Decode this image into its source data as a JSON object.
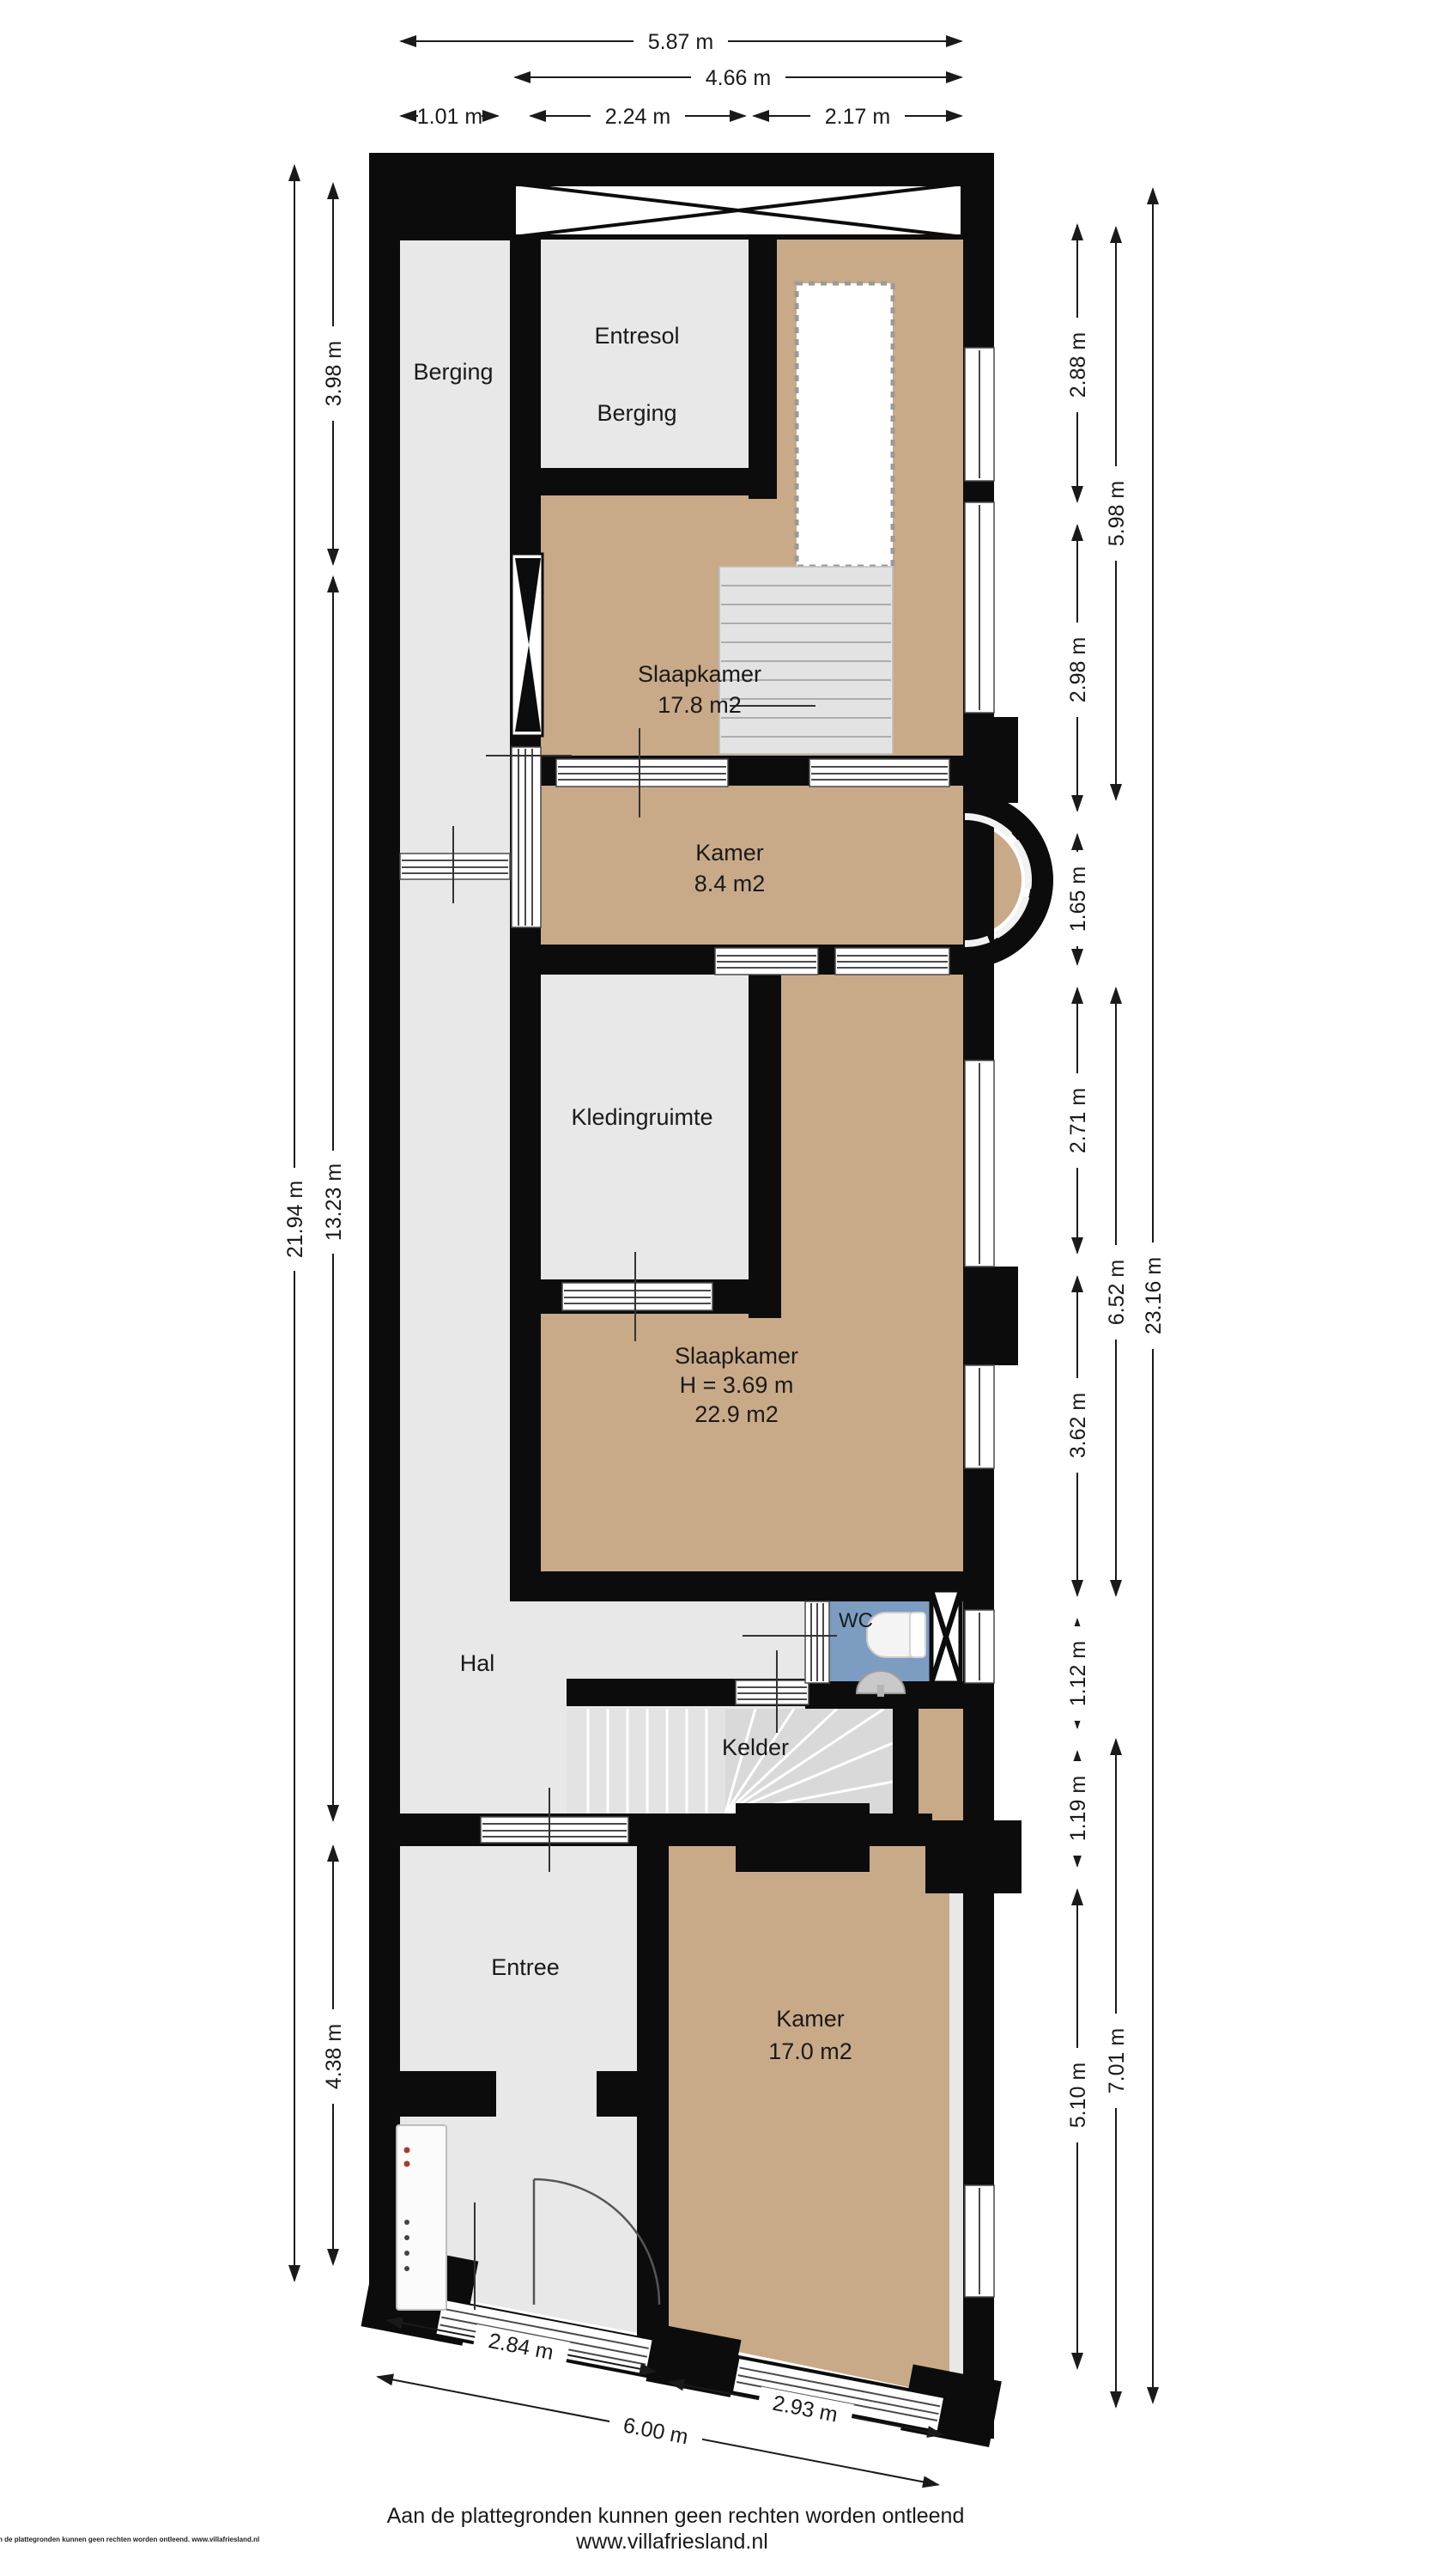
{
  "rooms": {
    "berging_left": {
      "label": "Berging"
    },
    "entresol": {
      "line1": "Entresol",
      "line2": "Berging"
    },
    "slaapkamer1": {
      "line1": "Slaapkamer",
      "line2": "17.8 m2"
    },
    "kamer1": {
      "line1": "Kamer",
      "line2": "8.4 m2"
    },
    "kledingruimte": {
      "label": "Kledingruimte"
    },
    "slaapkamer2": {
      "line1": "Slaapkamer",
      "line2": "H = 3.69 m",
      "line3": "22.9 m2"
    },
    "wc": {
      "label": "WC"
    },
    "hal": {
      "label": "Hal"
    },
    "kelder": {
      "label": "Kelder"
    },
    "entree": {
      "label": "Entree"
    },
    "kamer2": {
      "line1": "Kamer",
      "line2": "17.0 m2"
    }
  },
  "dimensions": {
    "top": [
      "5.87 m",
      "4.66 m",
      "1.01 m",
      "2.24 m",
      "2.17 m"
    ],
    "left": [
      "21.94 m",
      "3.98 m",
      "13.23 m",
      "4.38 m"
    ],
    "right_inner": [
      "2.88 m",
      "2.98 m",
      "1.65 m",
      "2.71 m",
      "3.62 m",
      "1.12 m",
      "1.19 m",
      "5.10 m"
    ],
    "right_middle": [
      "5.98 m",
      "6.52 m",
      "7.01 m"
    ],
    "right_outer": [
      "23.16 m"
    ],
    "bottom": [
      "2.84 m",
      "6.00 m",
      "2.93 m"
    ]
  },
  "footer": {
    "disclaimer": "Aan de plattegronden kunnen geen rechten worden ontleend",
    "website": "www.villafriesland.nl",
    "corner_note": "Aan de plattegronden kunnen geen rechten worden ontleend. www.villafriesland.nl"
  },
  "colors": {
    "wall": "#0c0c0c",
    "floor_gray": "#e8e8e8",
    "floor_tan": "#c9aa88",
    "wc_blue": "#7c9dc1",
    "stair_gray": "#e3e3e3",
    "fan_gray": "#d9d9d9"
  }
}
